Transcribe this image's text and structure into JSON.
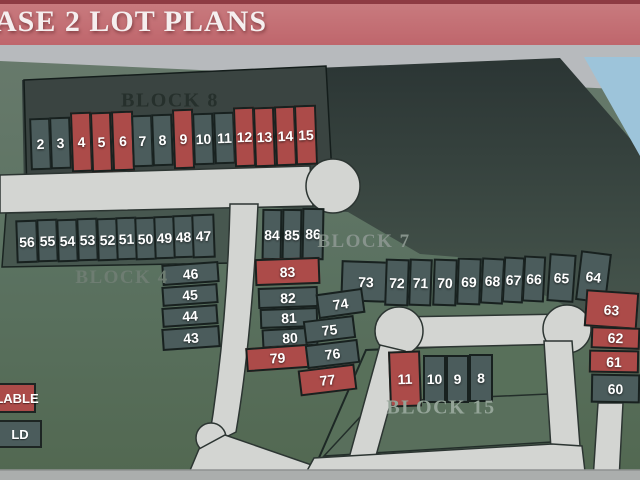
{
  "banner": {
    "title": "ASE 2 LOT PLANS"
  },
  "legend": {
    "available_label": "LABLE",
    "sold_label": "LD"
  },
  "colors": {
    "available": "#ac4b49",
    "sold": "#4b5c5c",
    "road": "#d3d5d2",
    "sky": "#9dc4da",
    "banner": "#c4696f",
    "banner_stripe": "#8e3b43"
  },
  "block_labels": [
    {
      "name": "BLOCK 8",
      "x": 170,
      "y": 101,
      "color": "#26302c",
      "size": 20
    },
    {
      "name": "BLOCK 4",
      "x": 122,
      "y": 278,
      "color": "#6e7d72",
      "size": 19
    },
    {
      "name": "BLOCK 7",
      "x": 364,
      "y": 242,
      "color": "#87938c",
      "size": 19
    },
    {
      "name": "BLOCK 15",
      "x": 441,
      "y": 408,
      "color": "#94a498",
      "size": 20
    }
  ],
  "lots": [
    {
      "label": "2",
      "status": "sold",
      "x": 30,
      "y": 118,
      "w": 21,
      "h": 52,
      "r": -2
    },
    {
      "label": "3",
      "status": "sold",
      "x": 50,
      "y": 117,
      "w": 21,
      "h": 52,
      "r": -2
    },
    {
      "label": "4",
      "status": "available",
      "x": 71,
      "y": 112,
      "w": 21,
      "h": 60,
      "r": -2
    },
    {
      "label": "5",
      "status": "available",
      "x": 91,
      "y": 112,
      "w": 21,
      "h": 60,
      "r": -2
    },
    {
      "label": "6",
      "status": "available",
      "x": 112,
      "y": 111,
      "w": 22,
      "h": 60,
      "r": -2
    },
    {
      "label": "7",
      "status": "sold",
      "x": 132,
      "y": 115,
      "w": 21,
      "h": 52,
      "r": -2
    },
    {
      "label": "8",
      "status": "sold",
      "x": 152,
      "y": 114,
      "w": 21,
      "h": 52,
      "r": -2
    },
    {
      "label": "9",
      "status": "available",
      "x": 173,
      "y": 109,
      "w": 21,
      "h": 60,
      "r": -2
    },
    {
      "label": "10",
      "status": "sold",
      "x": 193,
      "y": 113,
      "w": 21,
      "h": 52,
      "r": -2
    },
    {
      "label": "11",
      "status": "sold",
      "x": 214,
      "y": 112,
      "w": 21,
      "h": 52,
      "r": -2
    },
    {
      "label": "12",
      "status": "available",
      "x": 234,
      "y": 107,
      "w": 21,
      "h": 60,
      "r": -2
    },
    {
      "label": "13",
      "status": "available",
      "x": 254,
      "y": 107,
      "w": 21,
      "h": 60,
      "r": -2
    },
    {
      "label": "14",
      "status": "available",
      "x": 275,
      "y": 106,
      "w": 21,
      "h": 60,
      "r": -2
    },
    {
      "label": "15",
      "status": "available",
      "x": 295,
      "y": 105,
      "w": 22,
      "h": 60,
      "r": -2
    },
    {
      "label": "56",
      "status": "sold",
      "x": 16,
      "y": 220,
      "w": 22,
      "h": 43,
      "r": -2
    },
    {
      "label": "55",
      "status": "sold",
      "x": 37,
      "y": 219,
      "w": 21,
      "h": 43,
      "r": -2
    },
    {
      "label": "54",
      "status": "sold",
      "x": 57,
      "y": 219,
      "w": 21,
      "h": 43,
      "r": -2
    },
    {
      "label": "53",
      "status": "sold",
      "x": 77,
      "y": 218,
      "w": 21,
      "h": 43,
      "r": -2
    },
    {
      "label": "52",
      "status": "sold",
      "x": 97,
      "y": 218,
      "w": 21,
      "h": 43,
      "r": -2
    },
    {
      "label": "51",
      "status": "sold",
      "x": 116,
      "y": 217,
      "w": 21,
      "h": 43,
      "r": -2
    },
    {
      "label": "50",
      "status": "sold",
      "x": 135,
      "y": 217,
      "w": 21,
      "h": 43,
      "r": -2
    },
    {
      "label": "49",
      "status": "sold",
      "x": 154,
      "y": 216,
      "w": 21,
      "h": 43,
      "r": -2
    },
    {
      "label": "48",
      "status": "sold",
      "x": 173,
      "y": 215,
      "w": 21,
      "h": 43,
      "r": -2
    },
    {
      "label": "47",
      "status": "sold",
      "x": 192,
      "y": 214,
      "w": 23,
      "h": 44,
      "r": -2
    },
    {
      "label": "46",
      "status": "sold",
      "x": 162,
      "y": 263,
      "w": 57,
      "h": 21,
      "r": -4
    },
    {
      "label": "45",
      "status": "sold",
      "x": 162,
      "y": 285,
      "w": 56,
      "h": 20,
      "r": -4
    },
    {
      "label": "44",
      "status": "sold",
      "x": 162,
      "y": 306,
      "w": 56,
      "h": 20,
      "r": -4
    },
    {
      "label": "43",
      "status": "sold",
      "x": 162,
      "y": 327,
      "w": 58,
      "h": 22,
      "r": -4
    },
    {
      "label": "84",
      "status": "sold",
      "x": 262,
      "y": 209,
      "w": 20,
      "h": 51,
      "r": 1
    },
    {
      "label": "85",
      "status": "sold",
      "x": 282,
      "y": 209,
      "w": 20,
      "h": 51,
      "r": 1
    },
    {
      "label": "86",
      "status": "sold",
      "x": 302,
      "y": 208,
      "w": 22,
      "h": 52,
      "r": 1
    },
    {
      "label": "83",
      "status": "available",
      "x": 255,
      "y": 258,
      "w": 65,
      "h": 27,
      "r": -2
    },
    {
      "label": "82",
      "status": "sold",
      "x": 258,
      "y": 287,
      "w": 60,
      "h": 21,
      "r": -2
    },
    {
      "label": "81",
      "status": "sold",
      "x": 260,
      "y": 308,
      "w": 58,
      "h": 20,
      "r": -2
    },
    {
      "label": "80",
      "status": "sold",
      "x": 262,
      "y": 328,
      "w": 56,
      "h": 19,
      "r": -3
    },
    {
      "label": "79",
      "status": "available",
      "x": 246,
      "y": 346,
      "w": 63,
      "h": 24,
      "r": -4
    },
    {
      "label": "73",
      "status": "sold",
      "x": 341,
      "y": 261,
      "w": 50,
      "h": 41,
      "r": 2
    },
    {
      "label": "74",
      "status": "sold",
      "x": 317,
      "y": 291,
      "w": 47,
      "h": 25,
      "r": -8
    },
    {
      "label": "75",
      "status": "sold",
      "x": 304,
      "y": 318,
      "w": 51,
      "h": 23,
      "r": -7
    },
    {
      "label": "76",
      "status": "sold",
      "x": 306,
      "y": 342,
      "w": 53,
      "h": 24,
      "r": -7
    },
    {
      "label": "77",
      "status": "available",
      "x": 299,
      "y": 367,
      "w": 57,
      "h": 26,
      "r": -7
    },
    {
      "label": "72",
      "status": "sold",
      "x": 385,
      "y": 259,
      "w": 24,
      "h": 47,
      "r": 2
    },
    {
      "label": "71",
      "status": "sold",
      "x": 409,
      "y": 259,
      "w": 23,
      "h": 47,
      "r": 2
    },
    {
      "label": "70",
      "status": "sold",
      "x": 433,
      "y": 259,
      "w": 24,
      "h": 47,
      "r": 2
    },
    {
      "label": "69",
      "status": "sold",
      "x": 457,
      "y": 258,
      "w": 24,
      "h": 47,
      "r": 2
    },
    {
      "label": "68",
      "status": "sold",
      "x": 481,
      "y": 258,
      "w": 23,
      "h": 46,
      "r": 3
    },
    {
      "label": "67",
      "status": "sold",
      "x": 503,
      "y": 257,
      "w": 21,
      "h": 46,
      "r": 3
    },
    {
      "label": "66",
      "status": "sold",
      "x": 523,
      "y": 256,
      "w": 22,
      "h": 46,
      "r": 3
    },
    {
      "label": "65",
      "status": "sold",
      "x": 548,
      "y": 254,
      "w": 27,
      "h": 48,
      "r": 4
    },
    {
      "label": "64",
      "status": "sold",
      "x": 578,
      "y": 252,
      "w": 31,
      "h": 50,
      "r": 7
    },
    {
      "label": "63",
      "status": "available",
      "x": 585,
      "y": 291,
      "w": 53,
      "h": 37,
      "r": 4
    },
    {
      "label": "62",
      "status": "available",
      "x": 591,
      "y": 327,
      "w": 49,
      "h": 22,
      "r": 2
    },
    {
      "label": "61",
      "status": "available",
      "x": 589,
      "y": 350,
      "w": 50,
      "h": 23,
      "r": 1
    },
    {
      "label": "60",
      "status": "sold",
      "x": 591,
      "y": 374,
      "w": 49,
      "h": 29,
      "r": 1
    },
    {
      "label": "11",
      "status": "available",
      "x": 389,
      "y": 351,
      "w": 32,
      "h": 56,
      "r": -2
    },
    {
      "label": "10",
      "status": "sold",
      "x": 423,
      "y": 355,
      "w": 23,
      "h": 48,
      "r": 0
    },
    {
      "label": "9",
      "status": "sold",
      "x": 446,
      "y": 355,
      "w": 23,
      "h": 48,
      "r": 0
    },
    {
      "label": "8",
      "status": "sold",
      "x": 469,
      "y": 354,
      "w": 24,
      "h": 48,
      "r": 0
    }
  ]
}
